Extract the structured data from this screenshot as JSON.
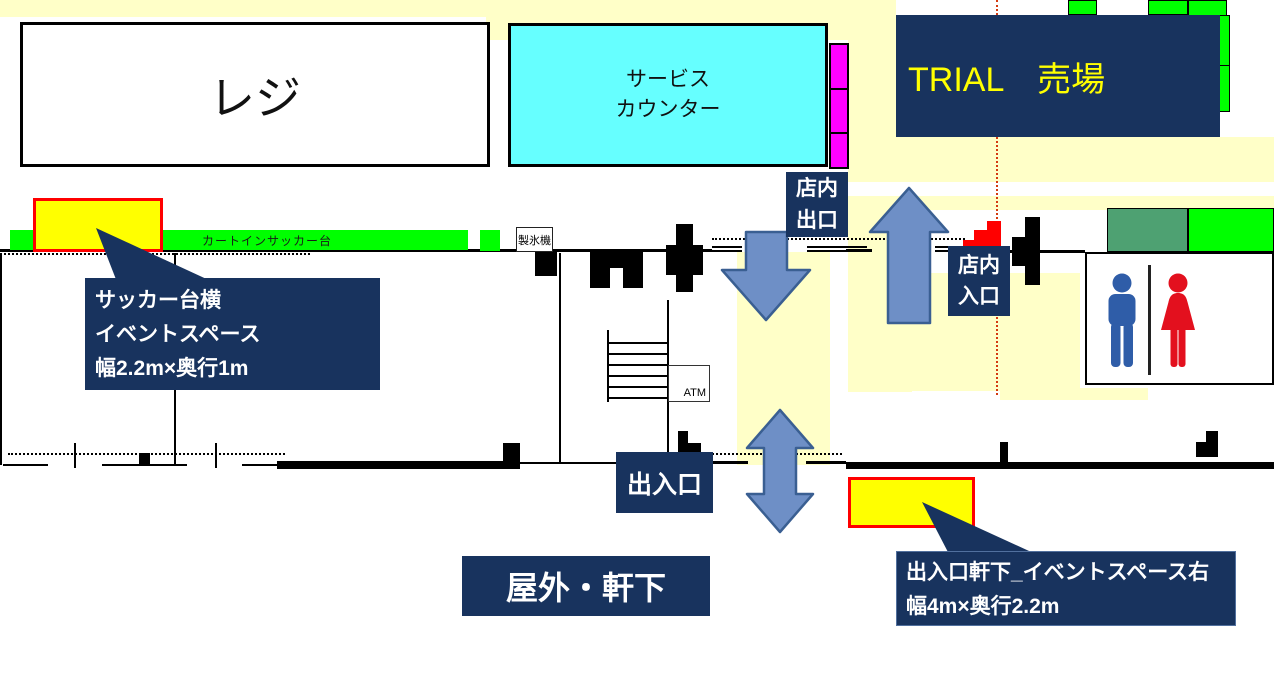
{
  "floorplan": {
    "register": {
      "label": "レジ"
    },
    "service_counter": {
      "line1": "サービス",
      "line2": "カウンター"
    },
    "trial_area": {
      "label": "TRIAL　売場"
    },
    "cart_sacker_bar": {
      "label": "カートインサッカー台"
    },
    "ice_machine": {
      "label": "製氷機"
    },
    "atm": {
      "label": "ATM"
    },
    "store_exit": {
      "line1": "店内",
      "line2": "出口"
    },
    "store_entrance": {
      "line1": "店内",
      "line2": "入口"
    },
    "doorway": {
      "label": "出入口"
    },
    "outdoor_eaves": {
      "label": "屋外・軒下"
    },
    "callout_sacker": {
      "line1": "サッカー台横",
      "line2": "イベントスペース",
      "line3": "幅2.2m×奥行1m"
    },
    "callout_doorway": {
      "line1": "出入口軒下_イベントスペース右",
      "line2": "幅4m×奥行2.2m"
    },
    "colors": {
      "navy": "#18335E",
      "path_yellow": "#FFFFC8",
      "highlight_yellow": "#FFFF00",
      "counter_cyan": "#66FFFF",
      "locker_magenta": "#FF00FF",
      "bright_green": "#00FF00",
      "dark_green": "#4EA172",
      "arrow_blue": "#6E8FC6",
      "event_border_red": "#FF0000",
      "male_icon_blue": "#2F5DA8",
      "female_icon_red": "#E3101E",
      "guide_line_red": "#D33A10"
    }
  }
}
